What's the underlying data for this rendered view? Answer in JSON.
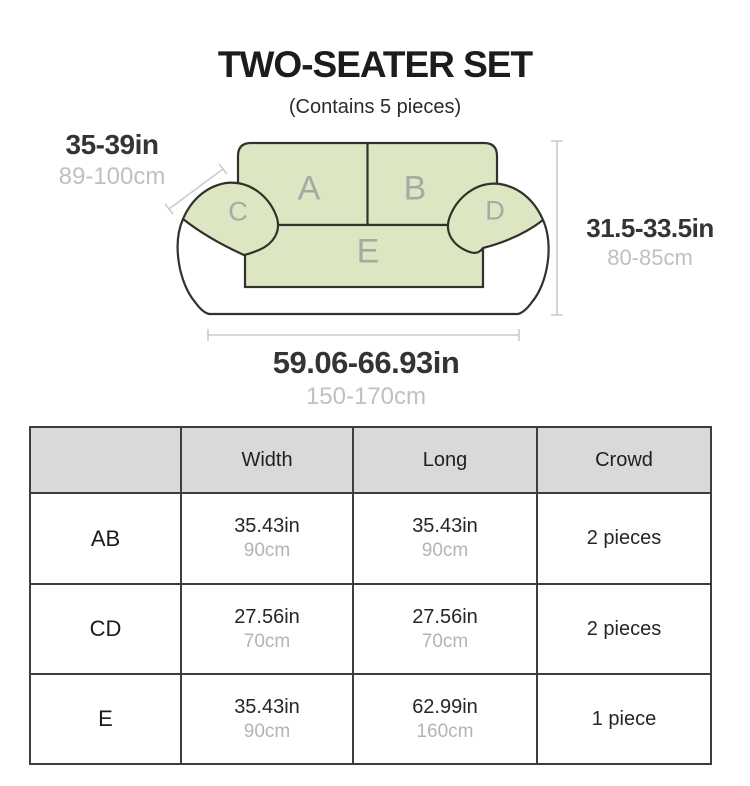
{
  "title": "TWO-SEATER SET",
  "subtitle": "(Contains 5 pieces)",
  "diagram": {
    "zone_labels": {
      "a": "A",
      "b": "B",
      "c": "C",
      "d": "D",
      "e": "E"
    },
    "measurements": {
      "back_width": {
        "in": "35-39in",
        "cm": "89-100cm"
      },
      "height": {
        "in": "31.5-33.5in",
        "cm": "80-85cm"
      },
      "length": {
        "in": "59.06-66.93in",
        "cm": "150-170cm"
      }
    },
    "colors": {
      "cover_green": "#dce6c3",
      "outline": "#32322a",
      "zone_letter_gray": "#a5aaa5",
      "measure_line_gray": "#cccccc"
    }
  },
  "table": {
    "headers": [
      "",
      "Width",
      "Long",
      "Crowd"
    ],
    "rows": [
      {
        "label": "AB",
        "width_in": "35.43in",
        "width_cm": "90cm",
        "long_in": "35.43in",
        "long_cm": "90cm",
        "crowd": "2 pieces"
      },
      {
        "label": "CD",
        "width_in": "27.56in",
        "width_cm": "70cm",
        "long_in": "27.56in",
        "long_cm": "70cm",
        "crowd": "2 pieces"
      },
      {
        "label": "E",
        "width_in": "35.43in",
        "width_cm": "90cm",
        "long_in": "62.99in",
        "long_cm": "160cm",
        "crowd": "1 piece"
      }
    ]
  }
}
